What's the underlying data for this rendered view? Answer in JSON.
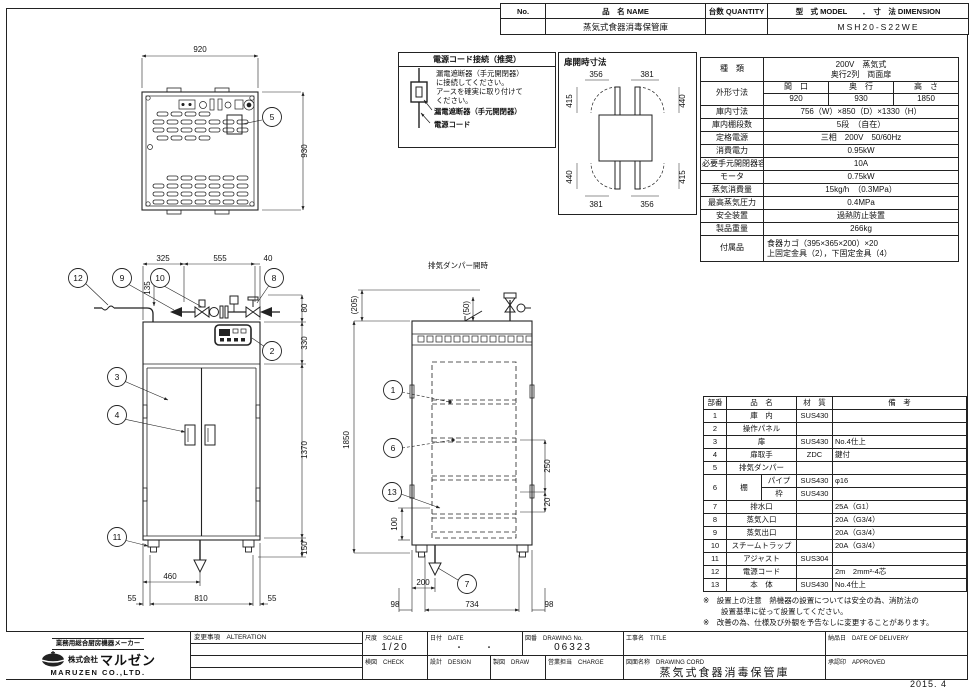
{
  "header_table": {
    "col_no": "No.",
    "col_name": "品　名 NAME",
    "col_qty": "台数 QUANTITY",
    "col_model_dim": "型　式 MODEL　　．　寸　法 DIMENSION",
    "value_name": "蒸気式食器消毒保管庫",
    "value_model": "MSH20-S22WE"
  },
  "power_note": {
    "title": "電源コード接続（推奨）",
    "line1": "漏電遮断器（手元開閉器）",
    "line2": "に接続してください。",
    "line3": "アースを確実に取り付けて",
    "line4": "ください。",
    "label_breaker": "漏電遮断器（手元開閉器）",
    "label_cord": "電源コード"
  },
  "door_open": {
    "title": "扉開時寸法",
    "dim_tl": "356",
    "dim_tr": "381",
    "dim_lt": "415",
    "dim_rt": "440",
    "dim_lb": "440",
    "dim_rb": "415",
    "dim_bl": "381",
    "dim_br": "356"
  },
  "spec": {
    "kind_label": "種　類",
    "kind_value1": "200V　蒸気式",
    "kind_value2": "奥行2列　両面扉",
    "outer_label": "外形寸法",
    "outer_col1": "間　口",
    "outer_col2": "奥　行",
    "outer_col3": "高　さ",
    "outer_val1": "920",
    "outer_val2": "930",
    "outer_val3": "1850",
    "rows": [
      {
        "label": "庫内寸法",
        "value": "756（W）×850（D）×1330（H）"
      },
      {
        "label": "庫内棚段数",
        "value": "5段　（自在）"
      },
      {
        "label": "定格電源",
        "value": "三相　200V　50/60Hz"
      },
      {
        "label": "消費電力",
        "value": "0.95kW"
      },
      {
        "label": "必要手元開閉器容量",
        "value": "10A"
      },
      {
        "label": "モータ",
        "value": "0.75kW"
      },
      {
        "label": "蒸気消費量",
        "value": "15kg/h　（0.3MPa）"
      },
      {
        "label": "最高蒸気圧力",
        "value": "0.4MPa"
      },
      {
        "label": "安全装置",
        "value": "過熱防止装置"
      },
      {
        "label": "製品重量",
        "value": "266kg"
      }
    ],
    "acc_label": "付属品",
    "acc_value1": "食器カゴ（395×365×200）×20",
    "acc_value2": "上固定金具（2），下固定金具（4）"
  },
  "views": {
    "top": {
      "dim_width": "920",
      "dim_depth": "930",
      "balloon_5": "5"
    },
    "front": {
      "dim_325": "325",
      "dim_555": "555",
      "dim_40": "40",
      "dim_135": "135",
      "dim_80": "80",
      "dim_330": "330",
      "dim_1370": "1370",
      "dim_150": "150",
      "dim_460": "460",
      "dim_55l": "55",
      "dim_810": "810",
      "dim_55r": "55",
      "b12": "12",
      "b9": "9",
      "b10": "10",
      "b8": "8",
      "b2": "2",
      "b3": "3",
      "b4": "4",
      "b11": "11"
    },
    "side": {
      "damper_label": "排気ダンパー開時",
      "dim_50": "(50)",
      "dim_205": "(205)",
      "dim_1850": "1850",
      "dim_250": "250",
      "dim_20": "20",
      "dim_100": "100",
      "dim_200": "200",
      "dim_98l": "98",
      "dim_734": "734",
      "dim_98r": "98",
      "b1": "1",
      "b6": "6",
      "b13": "13",
      "b7": "7"
    }
  },
  "parts": {
    "col_no": "部番",
    "col_name": "品　名",
    "col_material": "材　質",
    "col_note": "備　考",
    "rows": [
      {
        "no": "1",
        "name": "庫　内",
        "material": "SUS430",
        "note": ""
      },
      {
        "no": "2",
        "name": "操作パネル",
        "material": "",
        "note": ""
      },
      {
        "no": "3",
        "name": "扉",
        "material": "SUS430",
        "note": "No.4仕上"
      },
      {
        "no": "4",
        "name": "扉取手",
        "material": "ZDC",
        "note": "鍵付"
      },
      {
        "no": "5",
        "name": "排気ダンパー",
        "material": "",
        "note": ""
      },
      {
        "no": "7",
        "name": "排水口",
        "material": "",
        "note": "25A（G1）"
      },
      {
        "no": "8",
        "name": "蒸気入口",
        "material": "",
        "note": "20A（G3/4）"
      },
      {
        "no": "9",
        "name": "蒸気出口",
        "material": "",
        "note": "20A（G3/4）"
      },
      {
        "no": "10",
        "name": "スチームトラップ",
        "material": "",
        "note": "20A（G3/4）"
      },
      {
        "no": "11",
        "name": "アジャスト",
        "material": "SUS304",
        "note": ""
      },
      {
        "no": "12",
        "name": "電源コード",
        "material": "",
        "note": "2m　2mm²-4芯"
      },
      {
        "no": "13",
        "name": "本　体",
        "material": "SUS430",
        "note": "No.4仕上"
      }
    ],
    "shelf": {
      "no": "6",
      "name": "棚",
      "sub1": "パイプ",
      "mat1": "SUS430",
      "note1": "φ16",
      "sub2": "枠",
      "mat2": "SUS430",
      "note2": ""
    },
    "note1": "※　設置上の注意　熱機器の設置については安全の為、消防法の",
    "note2": "設置基準に従って設置してください。",
    "note3": "※　改善の為、仕様及び外観を予告なしに変更することがあります。"
  },
  "title_block": {
    "maker_tagline": "業務用総合厨房機器メーカー",
    "maker_prefix": "株式会社",
    "maker_brand": "マルゼン",
    "maker_en": "MARUZEN  CO.,LTD.",
    "alteration": "変更事項　ALTERATION",
    "scale_label": "尺度　SCALE",
    "scale_value": "1/20",
    "date_label": "日付　DATE",
    "date_value": "・　　・",
    "dwgno_label": "図番　DRAWING No.",
    "dwgno_value": "06323",
    "title_label": "工事名　TITLE",
    "delivery_label": "納品日　DATE OF DELIVERY",
    "check_label": "検図　CHECK",
    "design_label": "設計　DESIGN",
    "draw_label": "製図　DRAW",
    "charge_label": "営業担当　CHARGE",
    "dwgname_label": "図面名称　DRAWING CORD",
    "dwgname_value": "蒸気式食器消毒保管庫",
    "approved_label": "承認印　APPROVED"
  },
  "issue_date": "2015. 4"
}
